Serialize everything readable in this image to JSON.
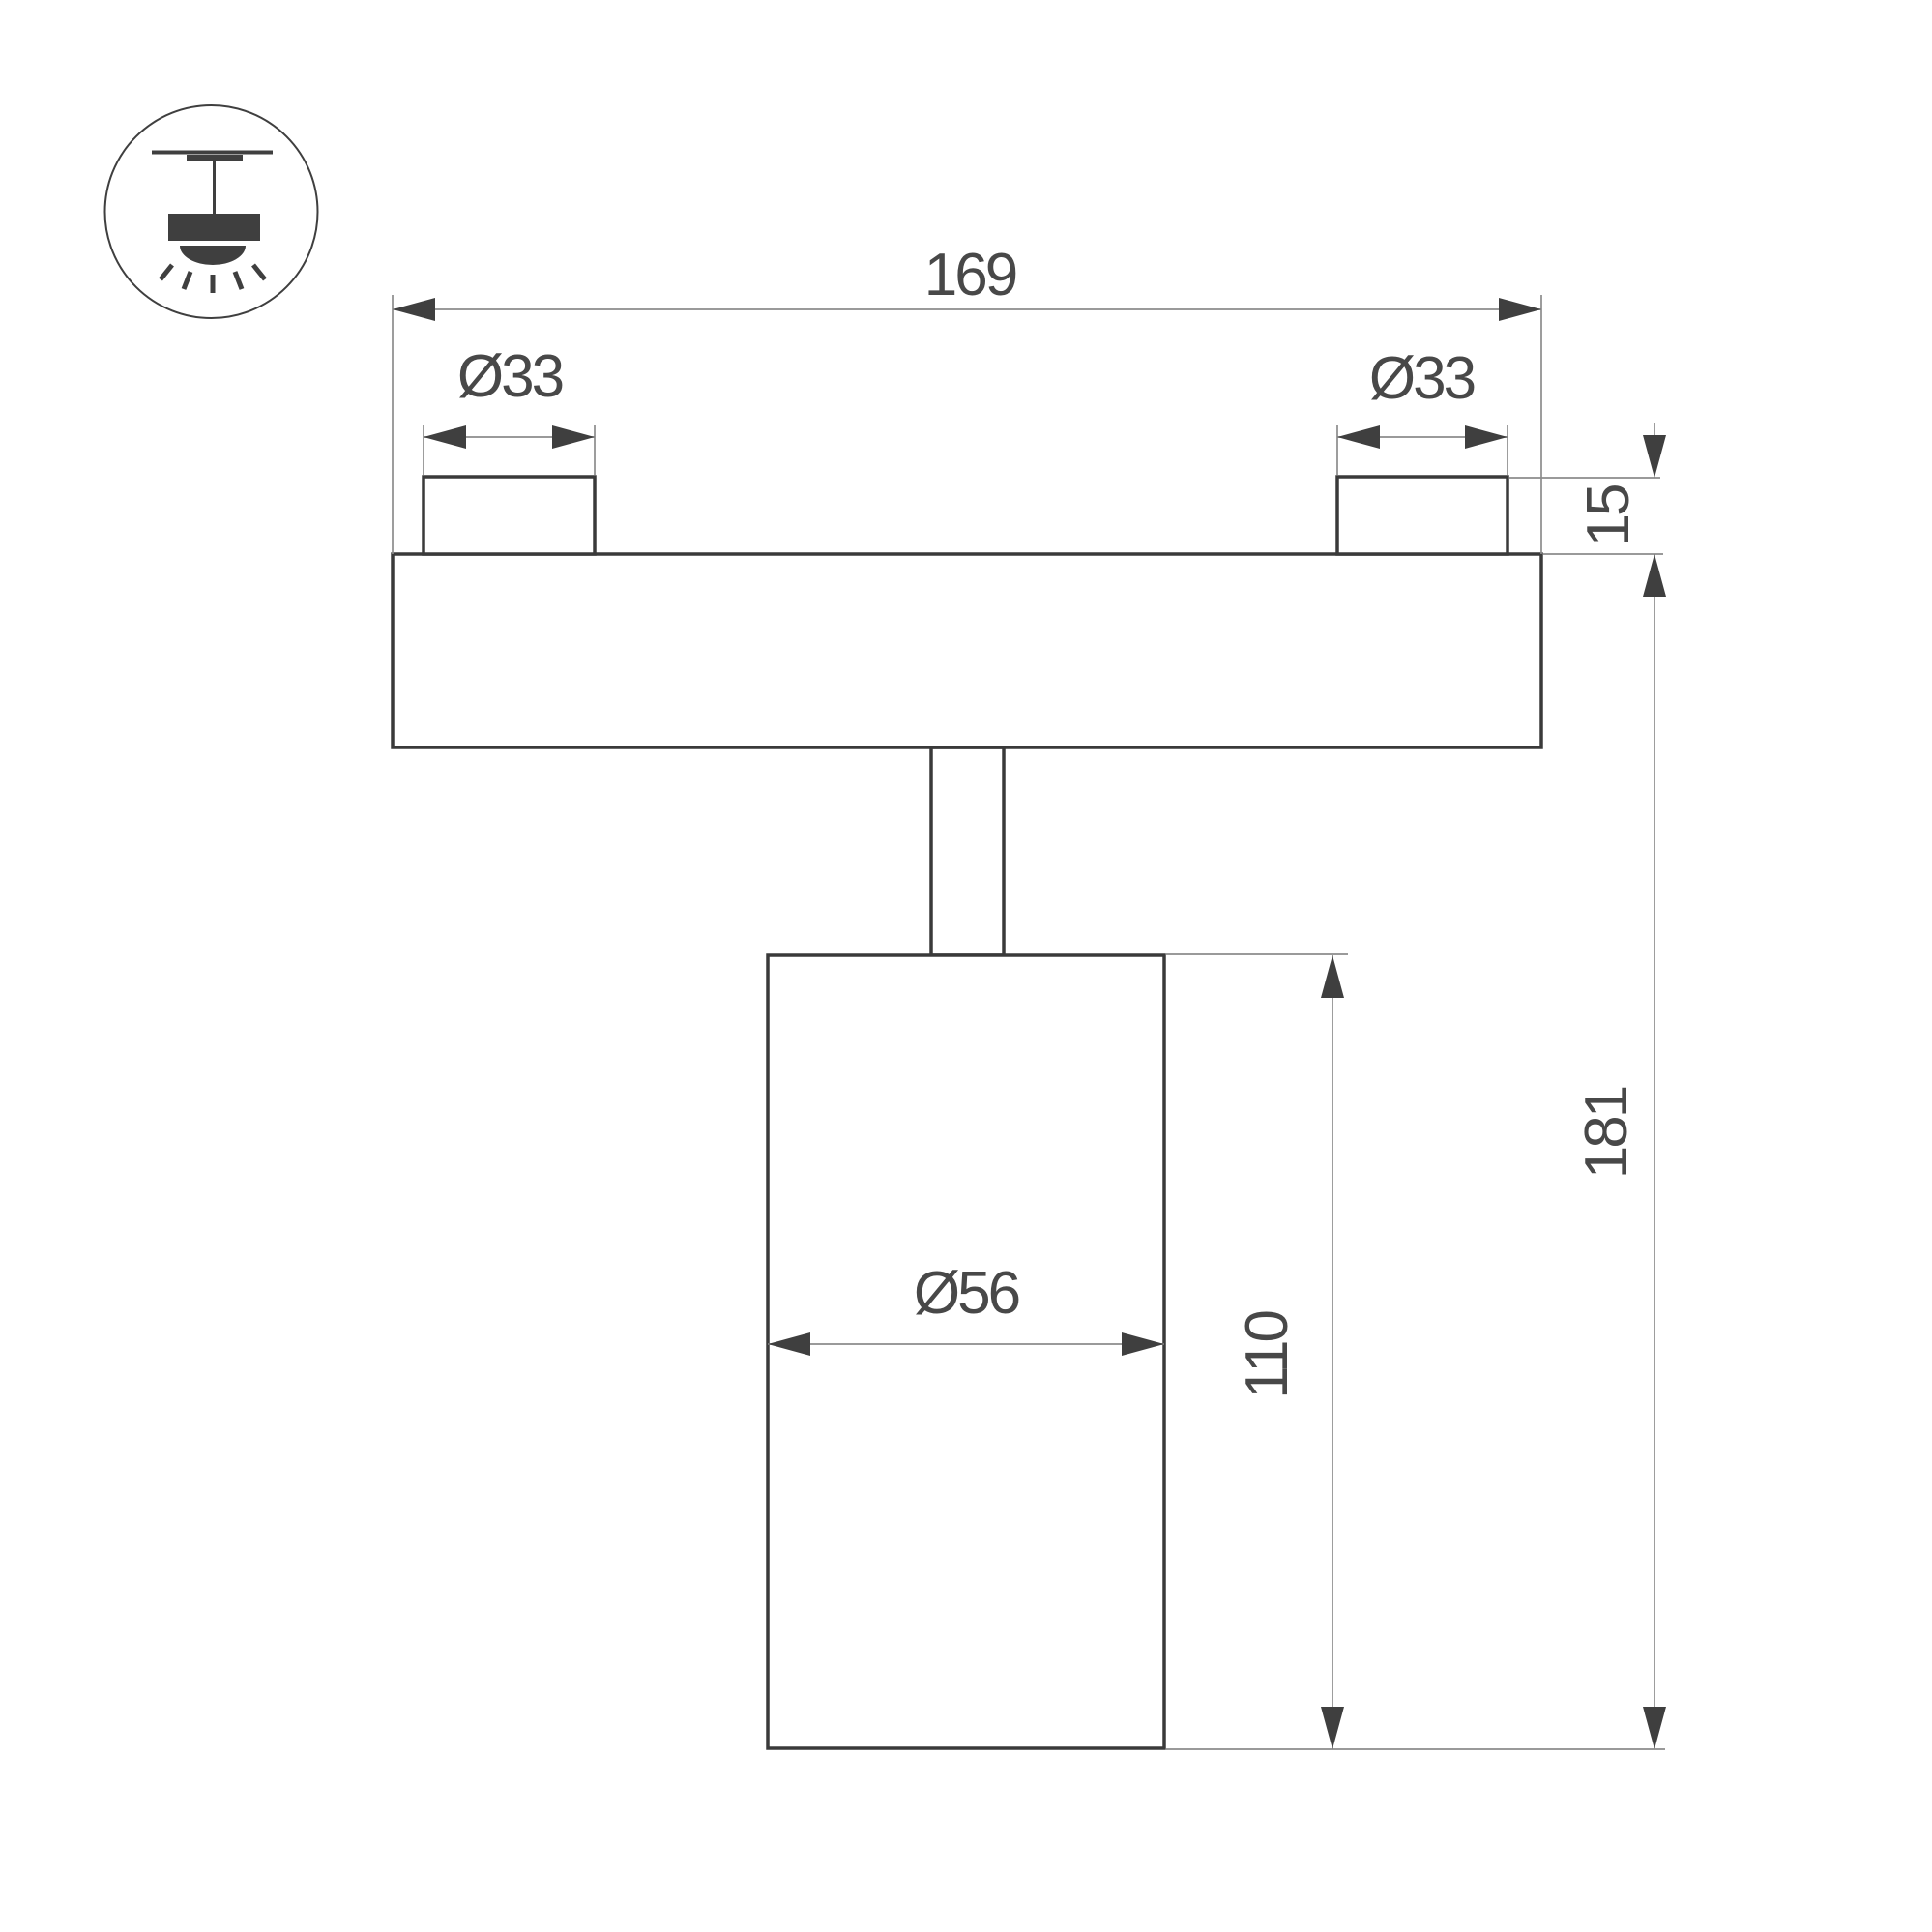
{
  "drawing": {
    "type": "technical dimension drawing",
    "subject": "ceiling track spotlight side view"
  },
  "icon": {
    "name": "ceiling-mounted-light-icon"
  },
  "dims": {
    "overall_width": "169",
    "left_boss_diameter": "Ø33",
    "right_boss_diameter": "Ø33",
    "boss_height": "15",
    "total_height": "181",
    "body_height": "110",
    "body_diameter": "Ø56"
  },
  "colors": {
    "background": "#ffffff",
    "outline": "#3a3a3a",
    "dimension_line": "#8c8c8c",
    "arrow": "#3f3f3f",
    "text": "#484848"
  }
}
